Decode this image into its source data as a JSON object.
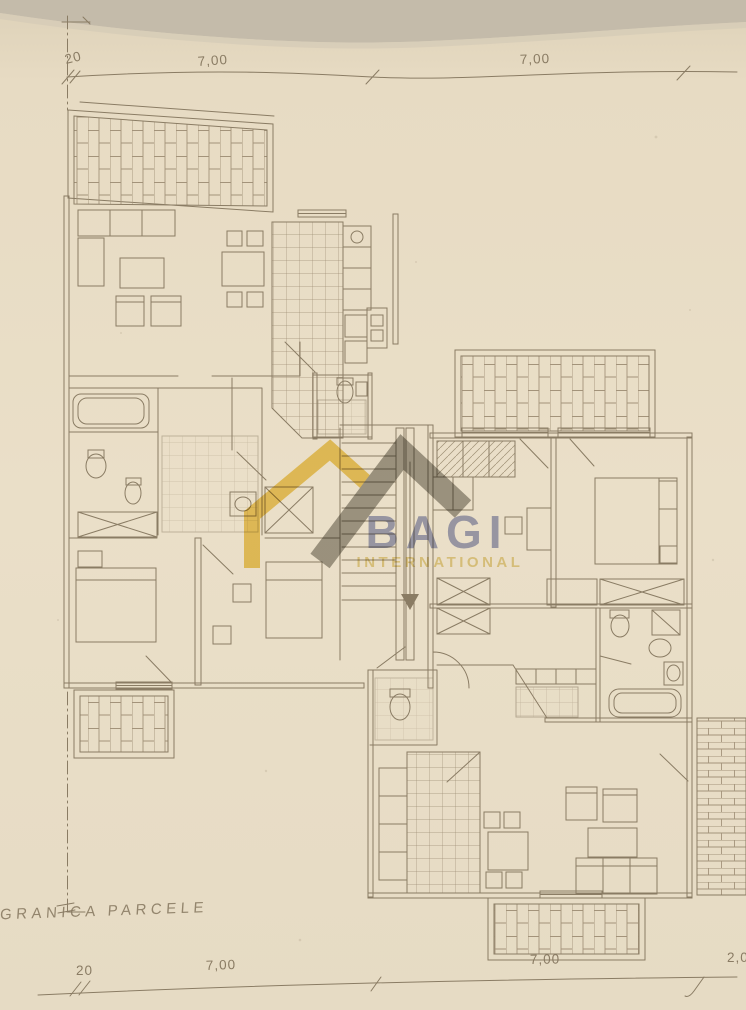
{
  "scan": {
    "paper_color": "#e9dec7",
    "paper_edge_color": "#e2d6bd",
    "top_shadow_color": "#c4bbaa",
    "ink_color": "#8a7c64",
    "hatch_color": "#a3937a"
  },
  "dimension_lines": {
    "top": {
      "offset": "20",
      "span_1": "7,00",
      "span_2": "7,00"
    },
    "bottom": {
      "offset": "20",
      "span_1": "7,00",
      "span_2": "7,00",
      "span_3": "2,0"
    }
  },
  "annotations": {
    "parcel_boundary_label": "GRANICA PARCELE"
  },
  "watermark": {
    "brand": "BAGI",
    "subtitle": "INTERNATIONAL",
    "brand_color": "#7e85b8",
    "subtitle_color": "#d9bd4f",
    "roof_gray": "#95928a",
    "house_yellow": "#eec84b"
  },
  "plan_legend": {
    "hatched_areas": [
      "terrace-top-left",
      "balcony-right-top",
      "balcony-bottom-left",
      "balcony-bottom-center",
      "terrace-right-edge"
    ],
    "fixtures": [
      "bathtub",
      "toilet",
      "sink",
      "bidet",
      "shower",
      "bed",
      "sofa",
      "armchair",
      "dining-table",
      "kitchen-counter",
      "staircase",
      "wardrobe-x",
      "door-swing"
    ]
  }
}
